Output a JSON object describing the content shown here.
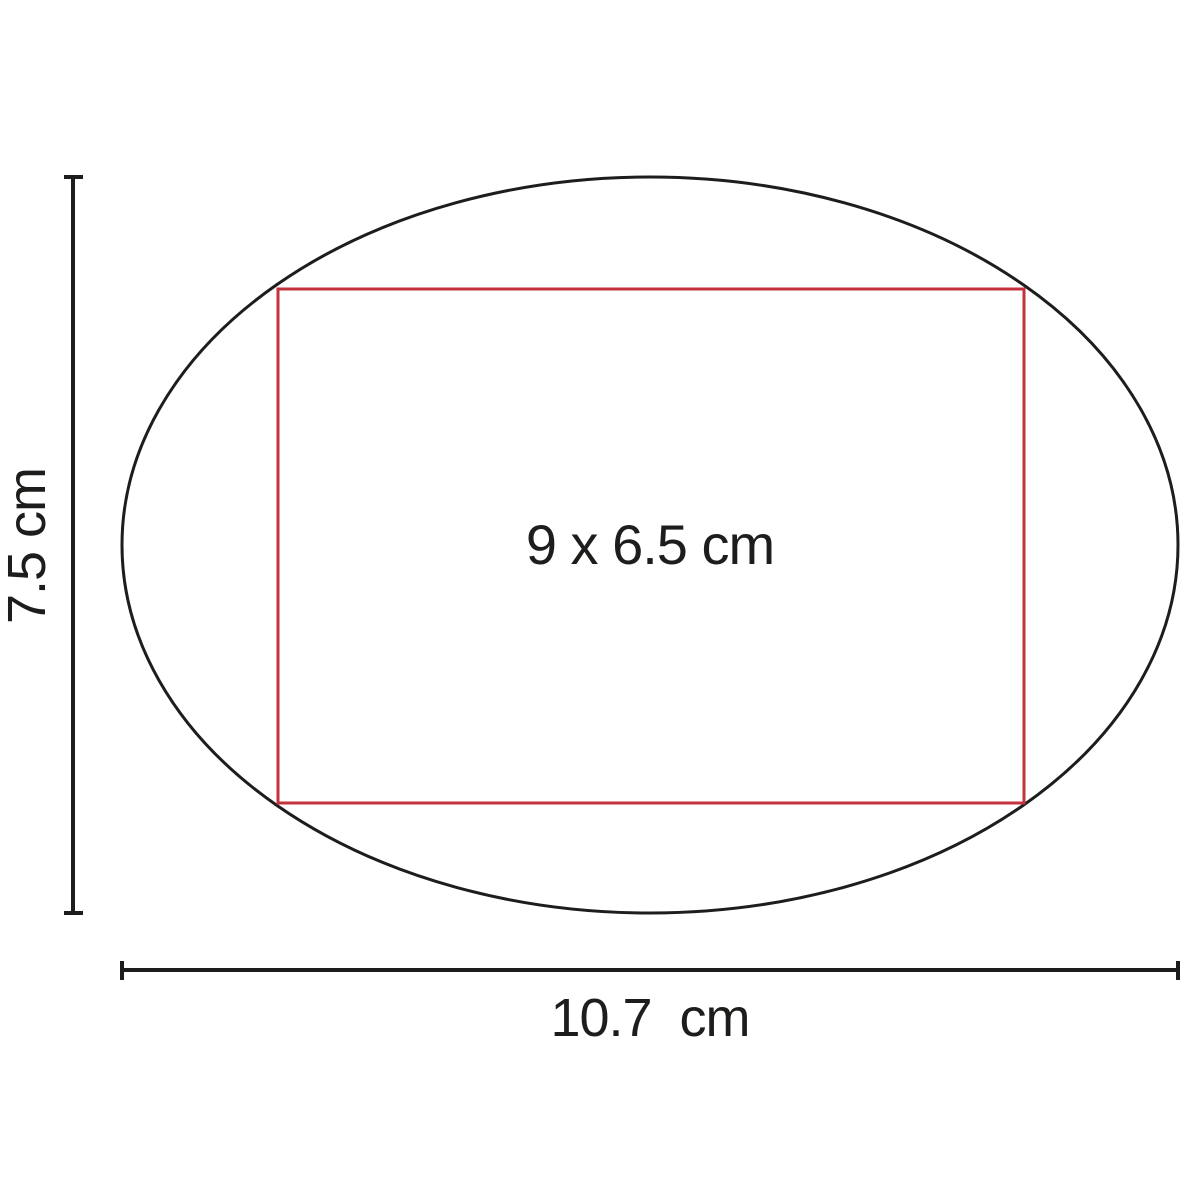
{
  "diagram": {
    "kind": "product-imprint-area-diagram",
    "shape": "oval",
    "print_area_label": "9 x 6.5 cm",
    "height_dimension": {
      "label": "7.5 cm",
      "value_cm": 7.5
    },
    "width_dimension": {
      "label": "10.7  cm",
      "value_cm": 10.7
    },
    "print_area": {
      "width_cm": 9,
      "height_cm": 6.5
    },
    "colors": {
      "outline": "#1d1d1b",
      "print_area_stroke": "#c4333c",
      "dimension_lines": "#1d1d1b",
      "label_text": "#1d1d1b",
      "background": "#ffffff"
    }
  }
}
